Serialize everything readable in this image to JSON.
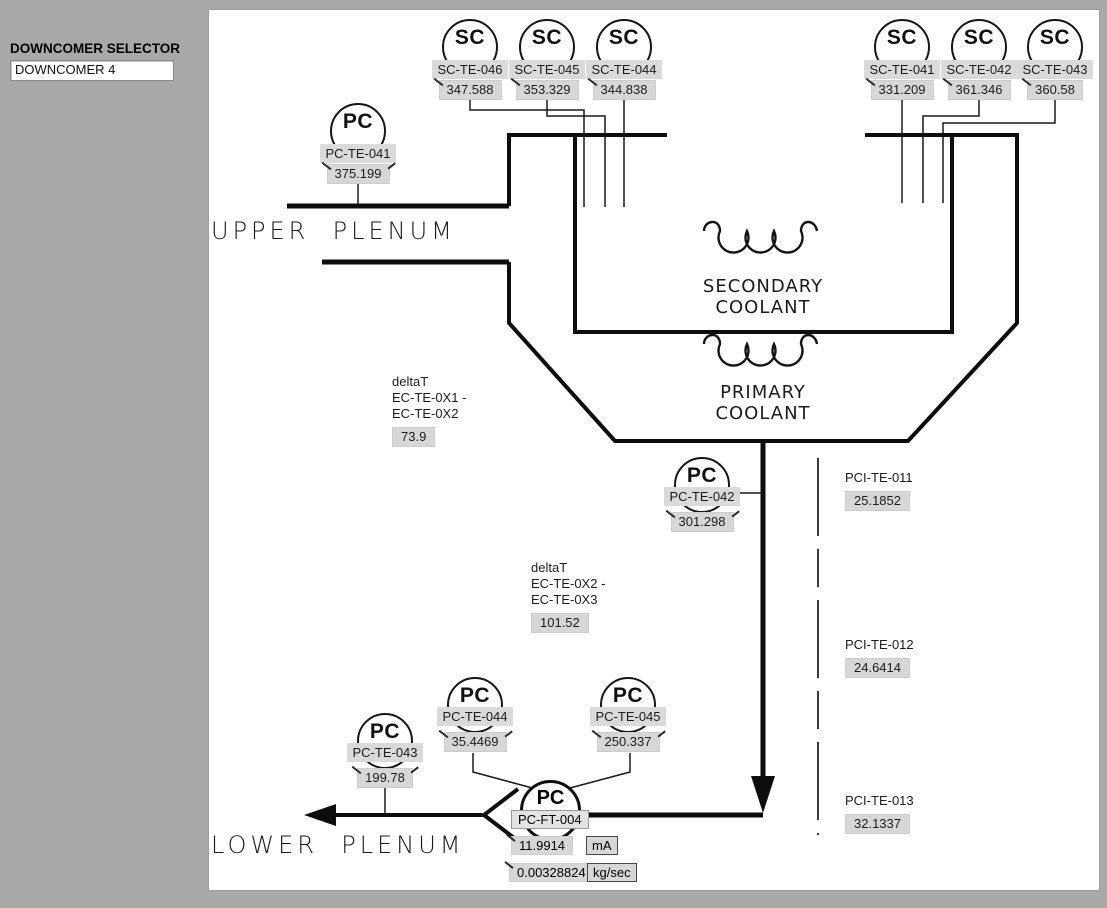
{
  "colors": {
    "frame_bg": "#a9a9a9",
    "canvas_bg": "#ffffff",
    "indicator_bg": "#d7d7d7",
    "line": "#000000"
  },
  "selector": {
    "label": "DOWNCOMER SELECTOR",
    "value": "DOWNCOMER 4"
  },
  "regions": {
    "upper_plenum": "UPPER  PLENUM",
    "lower_plenum": "LOWER  PLENUM",
    "secondary_coolant_line1": "SECONDARY",
    "secondary_coolant_line2": "COOLANT",
    "primary_coolant_line1": "PRIMARY",
    "primary_coolant_line2": "COOLANT"
  },
  "sensors": [
    {
      "letters": "SC",
      "tag": "SC-TE-046",
      "value": "347.588"
    },
    {
      "letters": "SC",
      "tag": "SC-TE-045",
      "value": "353.329"
    },
    {
      "letters": "SC",
      "tag": "SC-TE-044",
      "value": "344.838"
    },
    {
      "letters": "SC",
      "tag": "SC-TE-041",
      "value": "331.209"
    },
    {
      "letters": "SC",
      "tag": "SC-TE-042",
      "value": "361.346"
    },
    {
      "letters": "SC",
      "tag": "SC-TE-043",
      "value": "360.58"
    },
    {
      "letters": "PC",
      "tag": "PC-TE-041",
      "value": "375.199"
    },
    {
      "letters": "PC",
      "tag": "PC-TE-042",
      "value": "301.298"
    },
    {
      "letters": "PC",
      "tag": "PC-TE-044",
      "value": "35.4469"
    },
    {
      "letters": "PC",
      "tag": "PC-TE-045",
      "value": "250.337"
    },
    {
      "letters": "PC",
      "tag": "PC-TE-043",
      "value": "199.78"
    }
  ],
  "flow_transmitter": {
    "letters": "PC",
    "tag": "PC-FT-004",
    "current": "11.9914",
    "current_unit": "mA",
    "flow": "0.00328824",
    "flow_unit": "kg/sec"
  },
  "delta_t": [
    {
      "line1": "deltaT",
      "line2": "EC-TE-0X1 -",
      "line3": "EC-TE-0X2",
      "value": "73.9"
    },
    {
      "line1": "deltaT",
      "line2": "EC-TE-0X2 -",
      "line3": "EC-TE-0X3",
      "value": "101.52"
    }
  ],
  "pci_sensors": [
    {
      "tag": "PCI-TE-011",
      "value": "25.1852"
    },
    {
      "tag": "PCI-TE-012",
      "value": "24.6414"
    },
    {
      "tag": "PCI-TE-013",
      "value": "32.1337"
    }
  ]
}
